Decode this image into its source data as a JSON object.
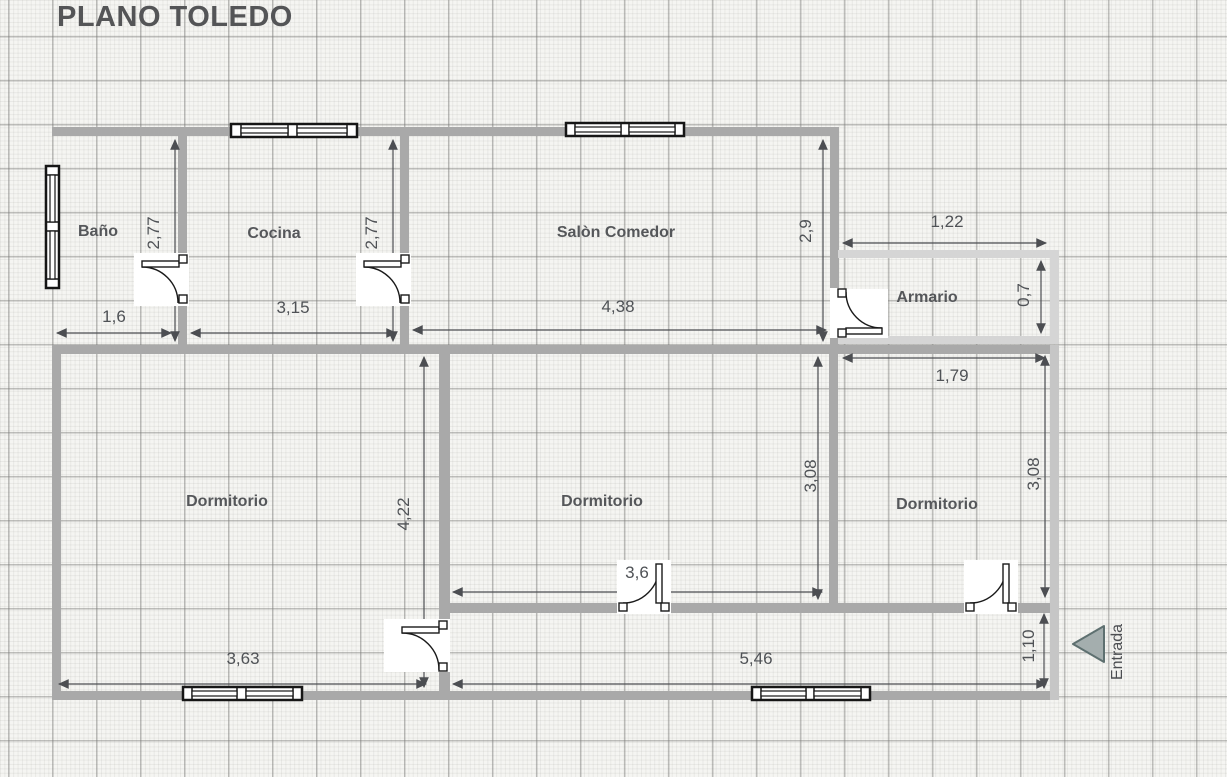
{
  "title": "PLANO TOLEDO",
  "rooms": {
    "bathroom": "Baño",
    "kitchen": "Cocina",
    "living_room": "Salòn Comedor",
    "closet": "Armario",
    "bedroom_left": "Dormitorio",
    "bedroom_middle": "Dormitorio",
    "bedroom_right": "Dormitorio"
  },
  "entrance_label": "Entrada",
  "dimensions": {
    "bathroom_height": "2,77",
    "bathroom_width": "1,6",
    "kitchen_height": "2,77",
    "kitchen_width": "3,15",
    "living_width": "4,38",
    "living_height": "2,9",
    "closet_width": "1,22",
    "closet_height": "0,7",
    "bedroom_right_width": "1,79",
    "bedroom_middle_height": "3,08",
    "bedroom_right_height": "3,08",
    "bedroom_left_height": "4,22",
    "bedroom_middle_width": "3,6",
    "bedroom_left_width": "3,63",
    "hallway_width": "5,46",
    "hallway_height": "1,10"
  },
  "colors": {
    "wall": "#a9a9a9",
    "wall_light": "#d5d5d5",
    "dimension": "#4c4e52",
    "entrance_fill": "#a4aeae",
    "entrance_border": "#5e7070"
  }
}
